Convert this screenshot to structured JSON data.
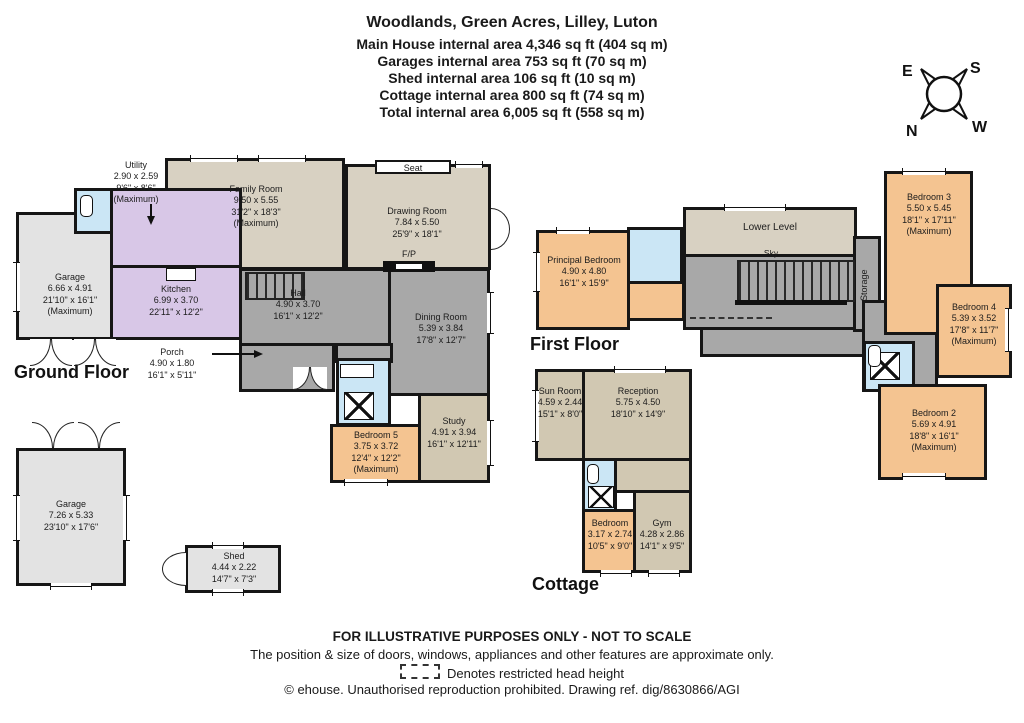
{
  "header": {
    "title": "Woodlands, Green Acres, Lilley, Luton",
    "line1": "Main House internal area 4,346 sq ft (404 sq m)",
    "line2": "Garages internal area 753 sq ft (70 sq m)",
    "line3": "Shed internal area 106 sq ft (10 sq m)",
    "line4": "Cottage internal area 800 sq ft (74 sq m)",
    "line5": "Total internal area 6,005 sq ft (558 sq m)"
  },
  "compass": {
    "n": "N",
    "e": "E",
    "s": "S",
    "w": "W"
  },
  "floor_labels": {
    "ground": "Ground Floor",
    "first": "First Floor",
    "cottage": "Cottage"
  },
  "rooms": {
    "garage_attached": {
      "name": "Garage",
      "m": "6.66 x 4.91",
      "ft": "21'10\" x 16'1\"",
      "note": "(Maximum)"
    },
    "utility": {
      "name": "Utility",
      "m": "2.90 x 2.59",
      "ft": "9'6\" x 8'6\"",
      "note": "(Maximum)"
    },
    "family_room": {
      "name": "Family Room",
      "m": "9.50 x 5.55",
      "ft": "31'2\" x 18'3\"",
      "note": "(Maximum)"
    },
    "drawing_room": {
      "name": "Drawing Room",
      "m": "7.84 x 5.50",
      "ft": "25'9\" x 18'1\""
    },
    "kitchen": {
      "name": "Kitchen",
      "m": "6.99 x 3.70",
      "ft": "22'11\" x 12'2\""
    },
    "hall": {
      "name": "Hall",
      "m": "4.90 x 3.70",
      "ft": "16'1\" x 12'2\""
    },
    "dining_room": {
      "name": "Dining Room",
      "m": "5.39 x 3.84",
      "ft": "17'8\" x 12'7\""
    },
    "porch": {
      "name": "Porch",
      "m": "4.90 x 1.80",
      "ft": "16'1\" x 5'11\""
    },
    "bedroom5": {
      "name": "Bedroom 5",
      "m": "3.75 x 3.72",
      "ft": "12'4\" x 12'2\"",
      "note": "(Maximum)"
    },
    "study": {
      "name": "Study",
      "m": "4.91 x 3.94",
      "ft": "16'1\" x 12'11\""
    },
    "principal_bedroom": {
      "name": "Principal Bedroom",
      "m": "4.90 x 4.80",
      "ft": "16'1\" x 15'9\""
    },
    "lower_level": {
      "name": "Lower Level"
    },
    "bedroom3": {
      "name": "Bedroom 3",
      "m": "5.50 x 5.45",
      "ft": "18'1\" x 17'11\"",
      "note": "(Maximum)"
    },
    "bedroom4": {
      "name": "Bedroom 4",
      "m": "5.39 x 3.52",
      "ft": "17'8\" x 11'7\"",
      "note": "(Maximum)"
    },
    "bedroom2": {
      "name": "Bedroom 2",
      "m": "5.69 x 4.91",
      "ft": "18'8\" x 16'1\"",
      "note": "(Maximum)"
    },
    "sun_room": {
      "name": "Sun Room",
      "m": "4.59 x 2.44",
      "ft": "15'1\" x 8'0\""
    },
    "reception": {
      "name": "Reception",
      "m": "5.75 x 4.50",
      "ft": "18'10\" x 14'9\""
    },
    "cottage_bedroom": {
      "name": "Bedroom",
      "m": "3.17 x 2.74",
      "ft": "10'5\" x 9'0\""
    },
    "gym": {
      "name": "Gym",
      "m": "4.28 x 2.86",
      "ft": "14'1\" x 9'5\""
    },
    "garage_detached": {
      "name": "Garage",
      "m": "7.26 x 5.33",
      "ft": "23'10\" x 17'6\""
    },
    "shed": {
      "name": "Shed",
      "m": "4.44 x 2.22",
      "ft": "14'7\" x 7'3\""
    }
  },
  "annotations": {
    "seat": "Seat",
    "fp": "F/P",
    "sky": "Sky",
    "storage": "Storage"
  },
  "footer": {
    "line1": "FOR ILLUSTRATIVE PURPOSES ONLY - NOT TO SCALE",
    "line2": "The position & size of doors, windows, appliances and other features are approximate only.",
    "line3": "Denotes restricted head height",
    "line4": "© ehouse. Unauthorised reproduction prohibited. Drawing ref. dig/8630866/AGI"
  },
  "colors": {
    "wall": "#161616",
    "living_beige": "#d8d1c2",
    "hall_gray": "#a8a8a8",
    "garage_gray": "#e3e3e3",
    "kitchen_lilac": "#d8c7e7",
    "bedroom_orange": "#f4c491",
    "study_tan": "#d1c8b2",
    "bath_blue": "#cbe6f5"
  }
}
